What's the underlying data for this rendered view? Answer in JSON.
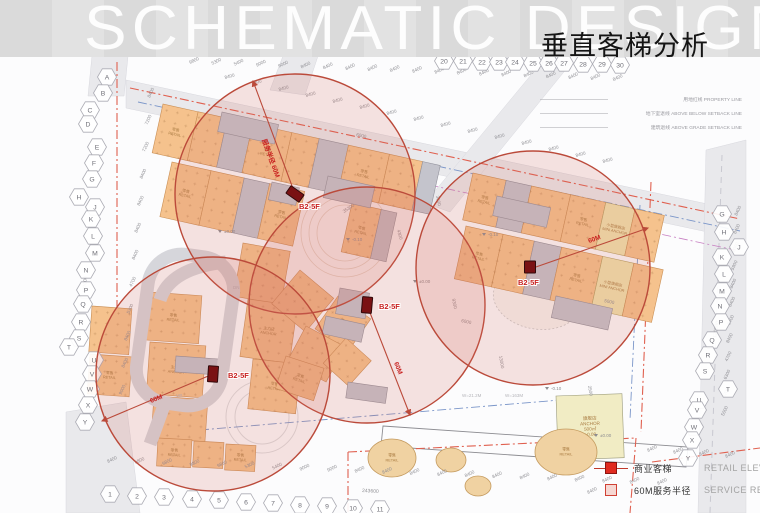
{
  "header": {
    "watermark": "SCHEMATIC DESIGN",
    "title": "垂直客梯分析"
  },
  "legend": {
    "items": [
      {
        "symbol": "filled-square",
        "zh": "商业客梯",
        "en": "RETAIL ELEVATOR"
      },
      {
        "symbol": "outline-square",
        "zh": "60M服务半径",
        "en": "SERVICE REDIUS"
      }
    ]
  },
  "boundary_labels": [
    {
      "zh": "用地红线",
      "en": "PROPERTY LINE",
      "x": 742,
      "y": 101
    },
    {
      "zh": "地下室退线",
      "en": "ABOVE BELOW SETBACK LINE",
      "x": 742,
      "y": 115
    },
    {
      "zh": "建筑退线",
      "en": "ABOVE GRADE SETBACK LINE",
      "x": 742,
      "y": 129
    }
  ],
  "analysis": {
    "service_radius_m": 60,
    "elevators": [
      {
        "label": "B2-5F",
        "x": 295,
        "y": 194,
        "rot": 35,
        "w": 16,
        "h": 9,
        "lx": 299,
        "ly": 209
      },
      {
        "label": "B2-5F",
        "x": 367,
        "y": 305,
        "rot": 5,
        "w": 10,
        "h": 16,
        "lx": 379,
        "ly": 309
      },
      {
        "label": "B2-5F",
        "x": 530,
        "y": 267,
        "rot": 0,
        "w": 11,
        "h": 12,
        "lx": 518,
        "ly": 285
      },
      {
        "label": "B2-5F",
        "x": 213,
        "y": 374,
        "rot": 4,
        "w": 10,
        "h": 16,
        "lx": 228,
        "ly": 378
      }
    ],
    "circles": [
      {
        "cx": 295,
        "cy": 194,
        "r": 120
      },
      {
        "cx": 367,
        "cy": 305,
        "r": 118
      },
      {
        "cx": 533,
        "cy": 268,
        "r": 117
      },
      {
        "cx": 213,
        "cy": 374,
        "r": 117
      }
    ],
    "radius_lines": [
      {
        "x1": 295,
        "y1": 194,
        "x2": 253,
        "y2": 81,
        "label": "服务半径 60M",
        "lx": 262,
        "ly": 140,
        "lrot": 70
      },
      {
        "x1": 367,
        "y1": 305,
        "x2": 410,
        "y2": 415,
        "label": "60M",
        "lx": 394,
        "ly": 363,
        "lrot": 68
      },
      {
        "x1": 533,
        "y1": 268,
        "x2": 648,
        "y2": 228,
        "label": "60M",
        "lx": 589,
        "ly": 243,
        "lrot": -19
      },
      {
        "x1": 213,
        "y1": 374,
        "x2": 102,
        "y2": 421,
        "label": "60M",
        "lx": 151,
        "ly": 403,
        "lrot": -22
      }
    ]
  },
  "grid": {
    "left": [
      {
        "t": "A",
        "x": 107,
        "y": 77
      },
      {
        "t": "B",
        "x": 103,
        "y": 93
      },
      {
        "t": "C",
        "x": 90,
        "y": 110
      },
      {
        "t": "D",
        "x": 88,
        "y": 124
      },
      {
        "t": "E",
        "x": 97,
        "y": 147
      },
      {
        "t": "F",
        "x": 94,
        "y": 163
      },
      {
        "t": "G",
        "x": 92,
        "y": 179
      },
      {
        "t": "H",
        "x": 79,
        "y": 197
      },
      {
        "t": "J",
        "x": 95,
        "y": 207
      },
      {
        "t": "K",
        "x": 91,
        "y": 219
      },
      {
        "t": "L",
        "x": 93,
        "y": 236
      },
      {
        "t": "M",
        "x": 95,
        "y": 253
      },
      {
        "t": "N",
        "x": 86,
        "y": 270
      },
      {
        "t": "P",
        "x": 86,
        "y": 290
      },
      {
        "t": "Q",
        "x": 83,
        "y": 304
      },
      {
        "t": "R",
        "x": 81,
        "y": 322
      },
      {
        "t": "S",
        "x": 79,
        "y": 338
      },
      {
        "t": "T",
        "x": 69,
        "y": 347
      },
      {
        "t": "U",
        "x": 94,
        "y": 360
      },
      {
        "t": "V",
        "x": 92,
        "y": 374
      },
      {
        "t": "W",
        "x": 90,
        "y": 389
      },
      {
        "t": "X",
        "x": 88,
        "y": 405
      },
      {
        "t": "Y",
        "x": 85,
        "y": 422
      }
    ],
    "right": [
      {
        "t": "G",
        "x": 722,
        "y": 214
      },
      {
        "t": "H",
        "x": 724,
        "y": 232
      },
      {
        "t": "J",
        "x": 739,
        "y": 247
      },
      {
        "t": "K",
        "x": 722,
        "y": 257
      },
      {
        "t": "L",
        "x": 724,
        "y": 274
      },
      {
        "t": "M",
        "x": 722,
        "y": 291
      },
      {
        "t": "N",
        "x": 720,
        "y": 306
      },
      {
        "t": "P",
        "x": 721,
        "y": 322
      },
      {
        "t": "Q",
        "x": 712,
        "y": 340
      },
      {
        "t": "R",
        "x": 708,
        "y": 355
      },
      {
        "t": "S",
        "x": 705,
        "y": 371
      },
      {
        "t": "T",
        "x": 728,
        "y": 389
      },
      {
        "t": "U",
        "x": 699,
        "y": 400
      },
      {
        "t": "V",
        "x": 697,
        "y": 410
      },
      {
        "t": "W",
        "x": 694,
        "y": 427
      },
      {
        "t": "X",
        "x": 692,
        "y": 440
      },
      {
        "t": "Y",
        "x": 688,
        "y": 458
      }
    ],
    "top": [
      {
        "t": "20",
        "x": 444,
        "y": 61
      },
      {
        "t": "21",
        "x": 463,
        "y": 61
      },
      {
        "t": "22",
        "x": 482,
        "y": 62
      },
      {
        "t": "23",
        "x": 499,
        "y": 62
      },
      {
        "t": "24",
        "x": 515,
        "y": 62
      },
      {
        "t": "25",
        "x": 533,
        "y": 63
      },
      {
        "t": "26",
        "x": 549,
        "y": 63
      },
      {
        "t": "27",
        "x": 564,
        "y": 63
      },
      {
        "t": "28",
        "x": 583,
        "y": 64
      },
      {
        "t": "29",
        "x": 602,
        "y": 64
      },
      {
        "t": "30",
        "x": 620,
        "y": 65
      }
    ],
    "bottom": [
      {
        "t": "1",
        "x": 110,
        "y": 494
      },
      {
        "t": "2",
        "x": 137,
        "y": 496
      },
      {
        "t": "3",
        "x": 164,
        "y": 497
      },
      {
        "t": "4",
        "x": 192,
        "y": 499
      },
      {
        "t": "5",
        "x": 219,
        "y": 500
      },
      {
        "t": "6",
        "x": 246,
        "y": 502
      },
      {
        "t": "7",
        "x": 273,
        "y": 503
      },
      {
        "t": "8",
        "x": 300,
        "y": 505
      },
      {
        "t": "9",
        "x": 327,
        "y": 506
      },
      {
        "t": "10",
        "x": 353,
        "y": 508
      },
      {
        "t": "11",
        "x": 380,
        "y": 509
      }
    ]
  },
  "dims": {
    "series": [
      {
        "name": "top-grid",
        "x": 190,
        "y": 64,
        "dx": 22.3,
        "dy": 0.9,
        "rot": -25,
        "values": [
          "9800",
          "5300",
          "5400",
          "9000",
          "9000",
          "8400",
          "8400",
          "8400",
          "8400",
          "8400",
          "8400",
          "8400",
          "8400",
          "8400",
          "8400",
          "8400",
          "8400",
          "8400",
          "8400",
          "8400"
        ]
      },
      {
        "name": "top-setback",
        "x": 225,
        "y": 79,
        "dx": 27,
        "dy": 6,
        "rot": -15,
        "values": [
          "8400",
          "8400",
          "8400",
          "8400",
          "8400",
          "8400",
          "8400",
          "8400",
          "8400",
          "8400",
          "8400",
          "8400",
          "8400",
          "8400",
          "8400"
        ]
      },
      {
        "name": "bottom-grid",
        "x": 108,
        "y": 463,
        "dx": 27.5,
        "dy": 1.1,
        "rot": -25,
        "values": [
          "8400",
          "9800",
          "9800",
          "9800",
          "9800",
          "5300",
          "5400",
          "9000",
          "9000",
          "8400",
          "8400",
          "8400",
          "8400",
          "8400",
          "8400",
          "8400",
          "8400",
          "8400",
          "8400",
          "8400",
          "8400"
        ]
      },
      {
        "name": "bottom-right",
        "x": 648,
        "y": 452,
        "dx": 26,
        "dy": 2,
        "rot": -25,
        "values": [
          "8400",
          "8400",
          "8400",
          "8400"
        ]
      },
      {
        "name": "right-grid",
        "x": 737,
        "y": 216,
        "dx": -1.2,
        "dy": 18.2,
        "rot": -65,
        "values": [
          "8400",
          "8400",
          "6000",
          "5900",
          "8400",
          "8400",
          "8400",
          "8400",
          "4700",
          "6300",
          "4700",
          "5000"
        ]
      },
      {
        "name": "left-grid",
        "x": 150,
        "y": 98,
        "dx": -2.6,
        "dy": 27,
        "rot": -65,
        "values": [
          "8400",
          "7200",
          "7200",
          "8400",
          "8400",
          "8400",
          "8400",
          "4700",
          "5300",
          "8400",
          "8400",
          "9000"
        ]
      }
    ],
    "totals": [
      {
        "t": "243600",
        "x": 452,
        "y": 57,
        "rot": 4
      },
      {
        "t": "243600",
        "x": 362,
        "y": 492,
        "rot": 3
      },
      {
        "t": "137000",
        "x": 86,
        "y": 293,
        "rot": -87
      },
      {
        "t": "120200",
        "x": 716,
        "y": 338,
        "rot": -80
      }
    ],
    "interior": [
      {
        "t": "6000",
        "x": 356,
        "y": 136,
        "rot": 12
      },
      {
        "t": "35300",
        "x": 344,
        "y": 213,
        "rot": -33
      },
      {
        "t": "4300",
        "x": 397,
        "y": 230,
        "rot": 75
      },
      {
        "t": "3600",
        "x": 436,
        "y": 196,
        "rot": 78
      },
      {
        "t": "9300",
        "x": 452,
        "y": 299,
        "rot": 78
      },
      {
        "t": "6000",
        "x": 461,
        "y": 322,
        "rot": 12
      },
      {
        "t": "13000",
        "x": 499,
        "y": 356,
        "rot": 80
      },
      {
        "t": "2500",
        "x": 588,
        "y": 386,
        "rot": 80
      },
      {
        "t": "5000",
        "x": 604,
        "y": 302,
        "rot": 12
      },
      {
        "t": "8400",
        "x": 588,
        "y": 494,
        "rot": -25
      }
    ]
  },
  "site_labels": {
    "block": {
      "retail": [
        "零售",
        "RETAIL"
      ],
      "mini_anchor": [
        "小型旗舰店",
        "MINI ANCHOR"
      ],
      "anchor": [
        "主力店",
        "ANCHOR"
      ],
      "flagship": [
        "旗舰店",
        "ANCHOR",
        "500㎡",
        "±0.00"
      ]
    },
    "elev_marks": [
      {
        "t": "±0.00",
        "x": 224,
        "y": 233
      },
      {
        "t": "-0.10",
        "x": 488,
        "y": 236
      },
      {
        "t": "-0.10",
        "x": 352,
        "y": 241
      },
      {
        "t": "±0.00",
        "x": 419,
        "y": 283
      },
      {
        "t": "-0.10",
        "x": 551,
        "y": 390
      },
      {
        "t": "±0.00",
        "x": 600,
        "y": 437
      }
    ],
    "misc": [
      {
        "t": "W=21.2M",
        "x": 462,
        "y": 397
      },
      {
        "t": "W=163M",
        "x": 505,
        "y": 397
      },
      {
        "t": "DN",
        "x": 233,
        "y": 289
      },
      {
        "t": "UP",
        "x": 176,
        "y": 397
      }
    ]
  },
  "colors": {
    "accent_red": "#c0392b",
    "marker_red": "#7a1113",
    "circle_stroke": "#bb4a3a",
    "circle_fill": "rgba(213,104,92,0.18)",
    "label_red": "#c8201f",
    "dash_red": "#e0604f",
    "dash_blue": "#7b96c9",
    "dash_magenta": "#c77fc2",
    "building_orange": "#f5c28d",
    "building_gray": "#c4c4cc",
    "building_yellow": "#efe3ae",
    "road_gray": "#e9e9ec"
  }
}
